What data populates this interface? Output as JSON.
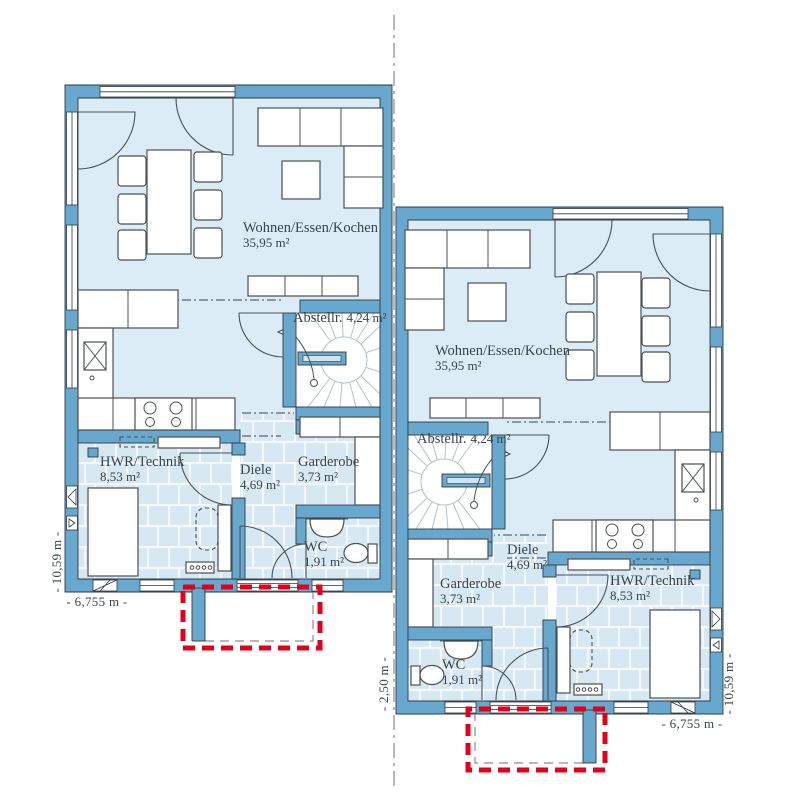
{
  "rooms": {
    "living": {
      "name": "Wohnen/Essen/Kochen",
      "area": "35,95 m²"
    },
    "storage": {
      "name": "Abstellr.",
      "area": "4,24 m²"
    },
    "utility": {
      "name": "HWR/Technik",
      "area": "8,53 m²"
    },
    "hall": {
      "name": "Diele",
      "area": "4,69 m²"
    },
    "wardrobe": {
      "name": "Garderobe",
      "area": "3,73 m²"
    },
    "wc": {
      "name": "WC",
      "area": "1,91 m²"
    }
  },
  "dimensions": {
    "left_height": "- 10,59 m -",
    "left_width": "- 6,755 m -",
    "center_offset": "- 2,50 m -",
    "right_height": "- 10,59 m -",
    "right_width": "- 6,755 m -"
  },
  "colors": {
    "wall": "#68a8ce",
    "floor": "#dcecf7",
    "accent_red": "#e2001a",
    "text": "#39444b",
    "mirror_line": "#999999"
  }
}
